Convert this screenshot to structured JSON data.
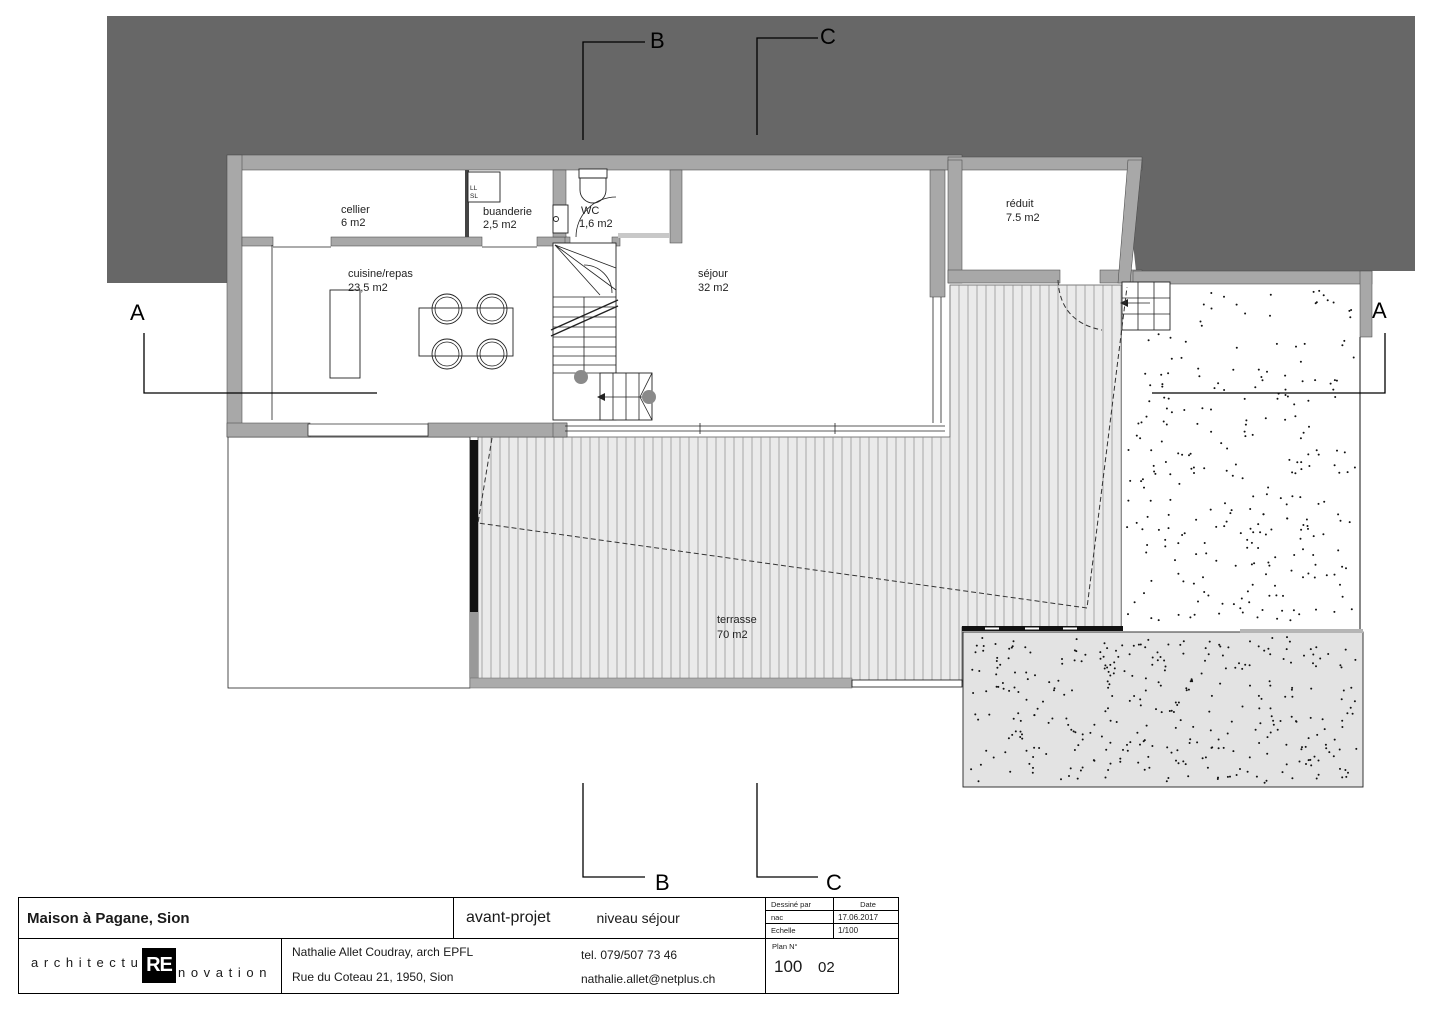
{
  "drawing": {
    "section_markers": {
      "a": "A",
      "b": "B",
      "c": "C"
    },
    "rooms": [
      {
        "name": "cellier",
        "area": "6 m2"
      },
      {
        "name": "buanderie",
        "area": "2,5 m2"
      },
      {
        "name": "WC",
        "area": "1,6 m2"
      },
      {
        "name": "cuisine/repas",
        "area": "23,5 m2"
      },
      {
        "name": "séjour",
        "area": "32 m2"
      },
      {
        "name": "réduit",
        "area": "7.5 m2"
      },
      {
        "name": "terrasse",
        "area": "70 m2"
      }
    ],
    "appliances": {
      "washer": "LL",
      "dryer": "SL"
    }
  },
  "title_block": {
    "project": "Maison à Pagane, Sion",
    "phase": "avant-projet",
    "level": "niveau séjour",
    "drawn_by_label": "Dessiné par",
    "drawn_by_value": "nac",
    "date_label": "Date",
    "date_value": "17.06.2017",
    "scale_label": "Echelle",
    "scale_value": "1/100",
    "plan_no_label": "Plan N°",
    "plan_no": "100",
    "plan_index": "02",
    "architect_name": "Nathalie Allet Coudray, arch EPFL",
    "architect_address": "Rue du Coteau 21, 1950, Sion",
    "phone": "tel. 079/507 73 46",
    "email": "nathalie.allet@netplus.ch",
    "logo_prefix": "a r c h i t e c t u",
    "logo_accent": "RE",
    "logo_suffix": "n o v a t i o n"
  },
  "colors": {
    "site_mass": "#676767",
    "walls": "#a8a8a8",
    "decking": "#eaeaea",
    "gravel_gray": "#e3e3e3",
    "line": "#1a1a1a"
  }
}
